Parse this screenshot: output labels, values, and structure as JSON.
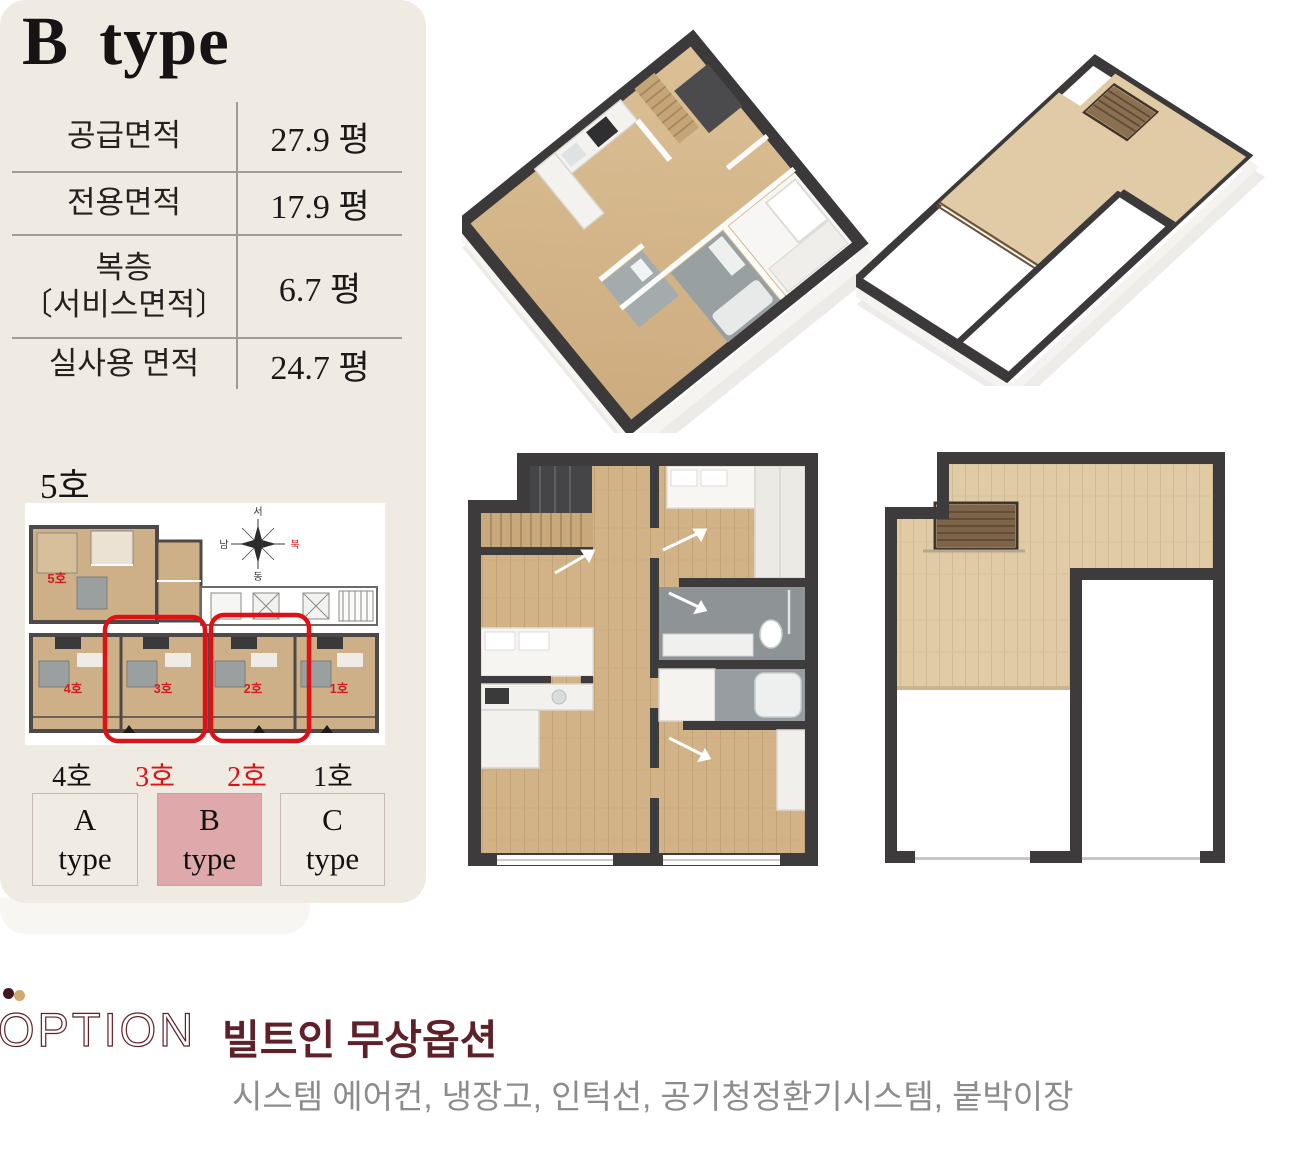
{
  "panel": {
    "title": "B type",
    "area_table": {
      "rows": [
        {
          "label": "공급면적",
          "label2": "",
          "value": "27.9 평"
        },
        {
          "label": "전용면적",
          "label2": "",
          "value": "17.9 평"
        },
        {
          "label": "복층",
          "label2": "〔서비스면적〕",
          "value": "6.7 평"
        },
        {
          "label": "실사용 면적",
          "label2": "",
          "value": "24.7 평"
        }
      ]
    },
    "floor_unit_label": "5호",
    "site_plan": {
      "plan_unit_labels": [
        "5호",
        "4호",
        "3호",
        "2호",
        "1호"
      ],
      "compass": {
        "top": "서",
        "left": "남",
        "right": "북",
        "bottom": "동"
      }
    },
    "unit_row_labels": [
      {
        "text": "4호",
        "highlighted": false
      },
      {
        "text": "3호",
        "highlighted": true
      },
      {
        "text": "2호",
        "highlighted": true
      },
      {
        "text": "1호",
        "highlighted": false
      }
    ],
    "type_buttons": [
      {
        "line1": "A",
        "line2": "type",
        "active": false
      },
      {
        "line1": "B",
        "line2": "type",
        "active": true
      },
      {
        "line1": "C",
        "line2": "type",
        "active": false
      }
    ]
  },
  "option_section": {
    "logo_text": "OPTION",
    "heading": "빌트인 무상옵션",
    "items": "시스템 에어컨, 냉장고, 인턱선, 공기청정환기시스템, 붙박이장"
  },
  "colors": {
    "panel_bg": "#f0ebe2",
    "active_pink": "#dfa8ab",
    "highlight_red": "#e01113",
    "maroon": "#5e2129",
    "logo_tan": "#cfa96d",
    "wall_dark": "#3d3b3c",
    "wood": "#d2b387",
    "subtitle_gray": "#8c8c8c"
  }
}
